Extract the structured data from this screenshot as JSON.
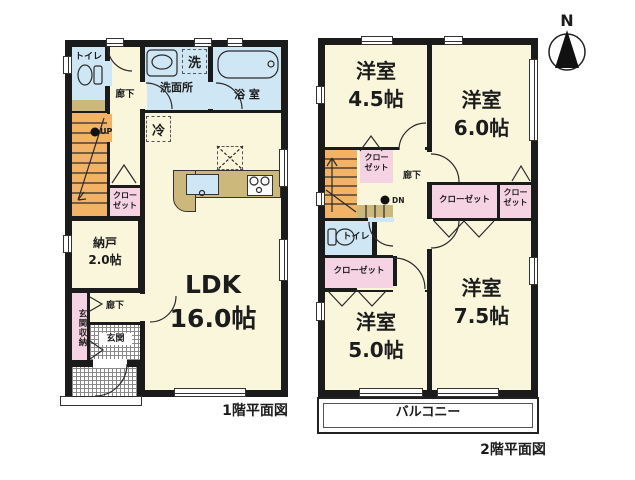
{
  "compass": {
    "label": "N"
  },
  "colors": {
    "wall": "#1b1b1b",
    "room": "#faf6dc",
    "water": "#cfe7f4",
    "closet": "#f6d3e2",
    "stairs": "#f2b366",
    "counter": "#cdb87c"
  },
  "floor1": {
    "caption": "1階平面図",
    "labels": {
      "toilet": "トイレ",
      "hall_upper": "廊下",
      "washroom": "洗面所",
      "laundry": "洗",
      "bath": "浴 室",
      "fridge": "冷",
      "up": "UP",
      "closet_line1": "クロー",
      "closet_line2": "ゼット",
      "storage_line1": "納戸",
      "storage_line2": "2.0帖",
      "entrance_storage": "玄関収納",
      "hall_lower": "廊下",
      "entrance": "玄関",
      "ldk_line1": "LDK",
      "ldk_line2": "16.0帖"
    }
  },
  "floor2": {
    "caption": "2階平面図",
    "labels": {
      "room45_line1": "洋室",
      "room45_line2": "4.5帖",
      "room60_line1": "洋室",
      "room60_line2": "6.0帖",
      "room75_line1": "洋室",
      "room75_line2": "7.5帖",
      "room50_line1": "洋室",
      "room50_line2": "5.0帖",
      "dn": "DN",
      "closet_a_line1": "クロー",
      "closet_a_line2": "ゼット",
      "hall": "廊下",
      "closet_wide": "クローゼット",
      "closet_b_line1": "クロー",
      "closet_b_line2": "ゼット",
      "toilet": "トイレ",
      "closet_c": "クローゼット",
      "balcony": "バルコニー"
    }
  }
}
